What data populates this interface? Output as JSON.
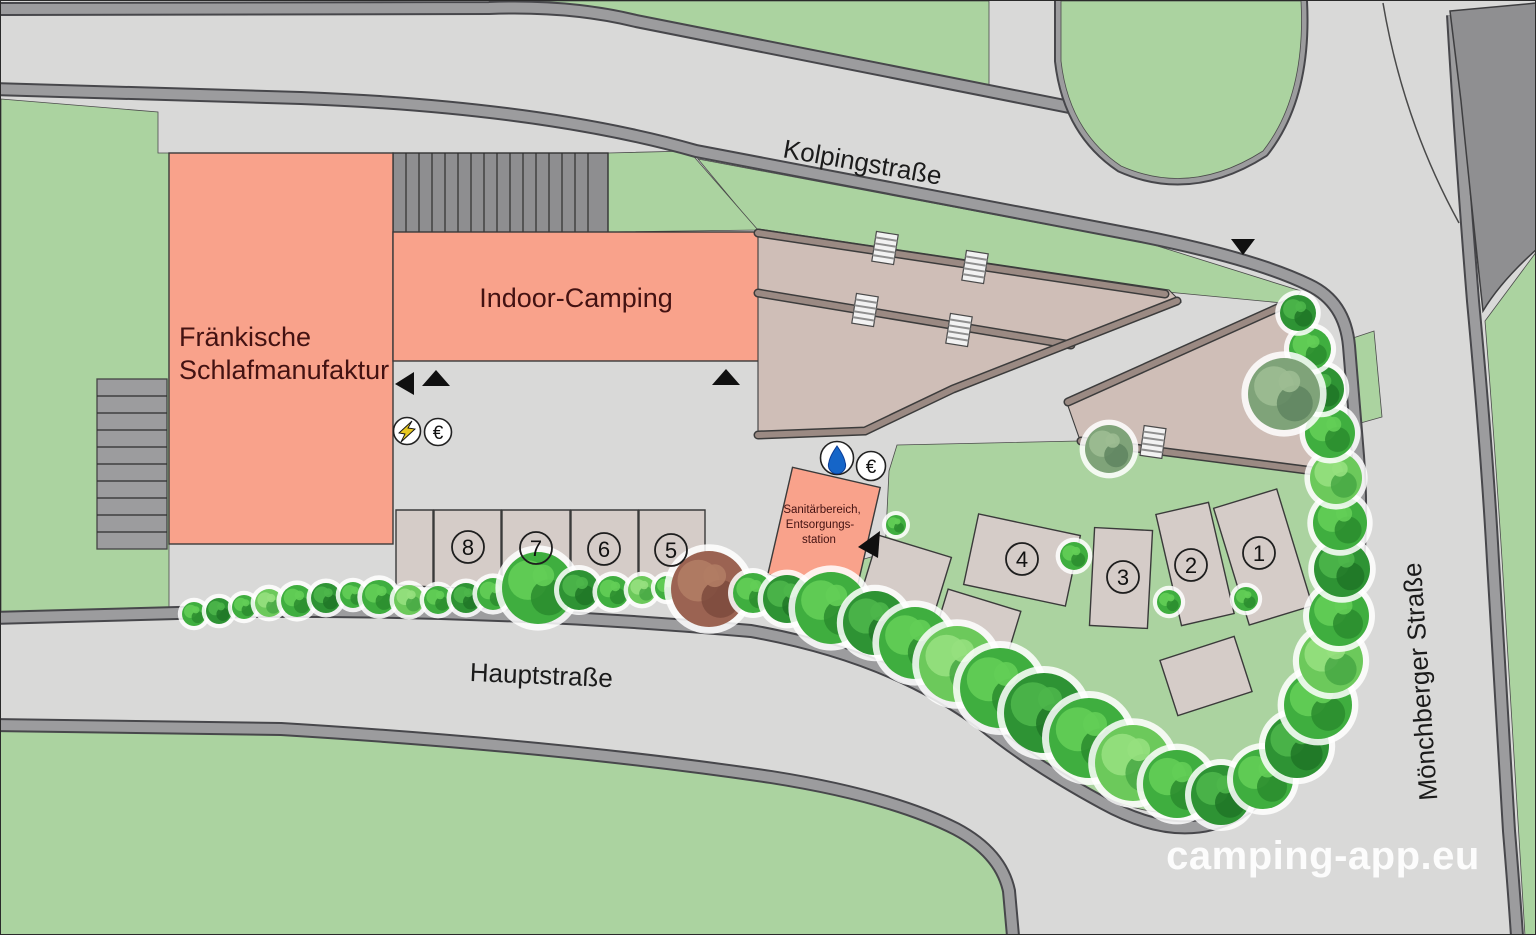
{
  "map": {
    "streets": {
      "kolpingstrasse": "Kolpingstraße",
      "hauptstrasse": "Hauptstraße",
      "moenchberger_strasse": "Mönchberger Straße"
    },
    "buildings": {
      "schlafmanufaktur": {
        "name_line1": "Fränkische",
        "name_line2": "Schlafmanufaktur"
      },
      "indoor_camping": {
        "name": "Indoor-Camping"
      },
      "sanitaer": {
        "name_line1": "Sanitärbereich,",
        "name_line2": "Entsorgungs-",
        "name_line3": "station"
      }
    },
    "pitches": [
      {
        "label": "1"
      },
      {
        "label": "2"
      },
      {
        "label": "3"
      },
      {
        "label": "4"
      },
      {
        "label": "5"
      },
      {
        "label": "6"
      },
      {
        "label": "7"
      },
      {
        "label": "8"
      }
    ],
    "icons": {
      "euro": "€"
    },
    "watermark": "camping-app.eu",
    "colors": {
      "road": "#d9d9d8",
      "sidewalk": "#9c9c9e",
      "lawn": "#abd3a0",
      "building": "#f9a28b",
      "pitch": "#d5ccc8",
      "terrace": "#cfbeb7",
      "terrace_wall": "#9b8a83",
      "text_dark": "#431212",
      "water": "#1565c8",
      "lightning": "#e8c820",
      "watermark": "#ffffff"
    }
  }
}
